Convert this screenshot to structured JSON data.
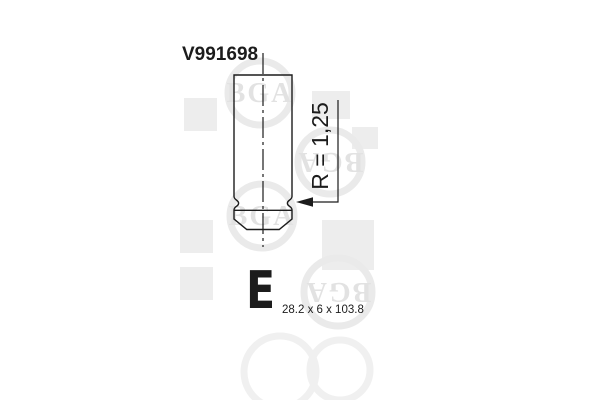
{
  "page": {
    "background_color": "#ffffff",
    "line_color": "#1c1c1c"
  },
  "drawing": {
    "part_number": "V991698",
    "radius_label": "R = 1,25",
    "valve_type_marker": "E",
    "dimensions_label": "28.2 x 6 x 103.8"
  },
  "watermark": {
    "brand": "BGA",
    "text_color": "#e2e2e2",
    "ring_color": "#eaeaea",
    "square_color": "#ededed"
  }
}
